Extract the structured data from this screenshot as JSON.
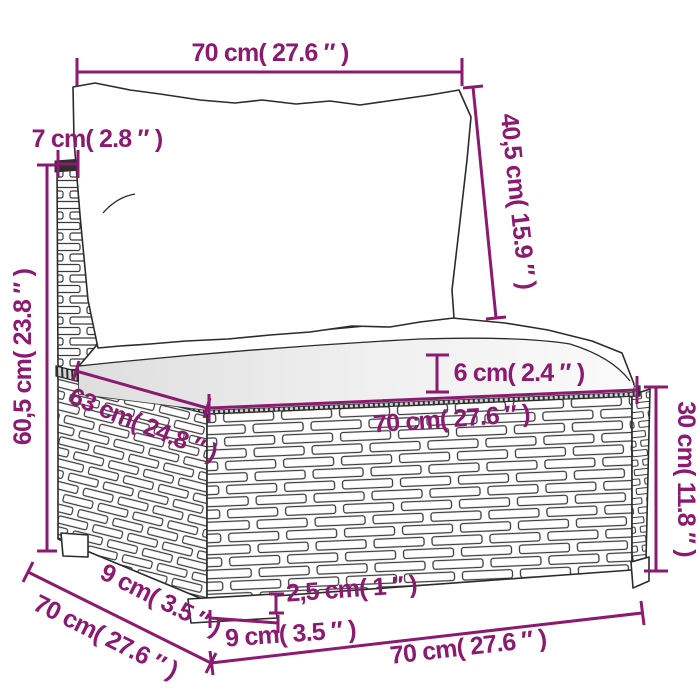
{
  "figure": {
    "kind": "product-dimension-diagram",
    "subject": "poly rattan middle sofa section with back cushion and seat cushion",
    "background_color": "#ffffff",
    "accent_color": "#8B1A70",
    "lineart_color": "#2b2b2b"
  },
  "dims": {
    "pillow_width": {
      "what": "back cushion width (top)",
      "text": "70 cm( 27.6 ″ )"
    },
    "back_thickness": {
      "what": "back panel thickness",
      "text": "7 cm( 2.8 ″ )"
    },
    "pillow_height": {
      "what": "back cushion height (right)",
      "text": "40,5 cm( 15.9 ″ )"
    },
    "back_height": {
      "what": "overall back height (left)",
      "text": "60,5 cm( 23.8 ″ )"
    },
    "cushion_thickness": {
      "what": "seat cushion thickness",
      "text": "6 cm( 2.4 ″ )"
    },
    "seat_depth": {
      "what": "base depth along left top edge",
      "text": "63 cm( 24.8 ″ )"
    },
    "seat_width": {
      "what": "base width along front top edge",
      "text": "70 cm( 27.6 ″ )"
    },
    "base_height": {
      "what": "base height (right)",
      "text": "30 cm( 11.8 ″ )"
    },
    "foot_inset": {
      "what": "foot inset along bottom-left",
      "text": "9 cm( 3.5 ″ )"
    },
    "total_depth": {
      "what": "overall depth (bottom-left)",
      "text": "70 cm( 27.6 ″ )"
    },
    "foot_height": {
      "what": "foot height",
      "text": "2,5 cm( 1 ″ )"
    },
    "foot_width": {
      "what": "foot width",
      "text": "9 cm( 3.5 ″ )"
    },
    "total_width": {
      "what": "overall width (bottom)",
      "text": "70 cm( 27.6 ″ )"
    }
  }
}
